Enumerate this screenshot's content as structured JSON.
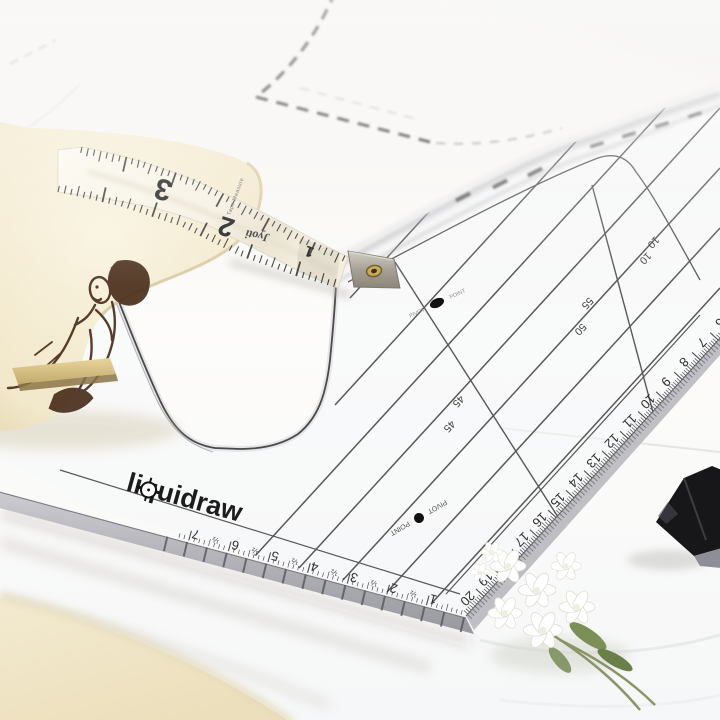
{
  "ruler": {
    "brand": "liquidraw",
    "pivot_point_label": "PIVOT POINT",
    "right_edge_scale": [
      "6",
      "7",
      "8",
      "9",
      "10",
      "11",
      "12",
      "13",
      "14",
      "15",
      "16",
      "17",
      "18",
      "19",
      "20"
    ],
    "bottom_edge_scale": [
      "7",
      "6",
      "5",
      "4",
      "3",
      "2",
      "1"
    ],
    "half_mark": "½",
    "diagonal_labels": [
      "45",
      "45",
      "50",
      "55",
      "10",
      "10"
    ]
  },
  "tape_measure": {
    "brand": "Jyoti",
    "product_label": "Tape Measure",
    "visible_numbers": [
      "3",
      "2",
      "1"
    ]
  },
  "colors": {
    "background": "#f7f5f1",
    "fabric_white": "#fcfcfc",
    "table_cream": "#efe5c6",
    "roll_paper": "#f5edd6",
    "illustration_ink": "#4a2e1c",
    "wood_strip": "#d7bf85",
    "ruler_line": "#3d3d3d",
    "brass_eyelet": "#c9a84c",
    "metal_tip": "#a8a298",
    "flower_white": "#ffffff",
    "leaf_green": "#73855a",
    "object_black": "#17171a"
  }
}
